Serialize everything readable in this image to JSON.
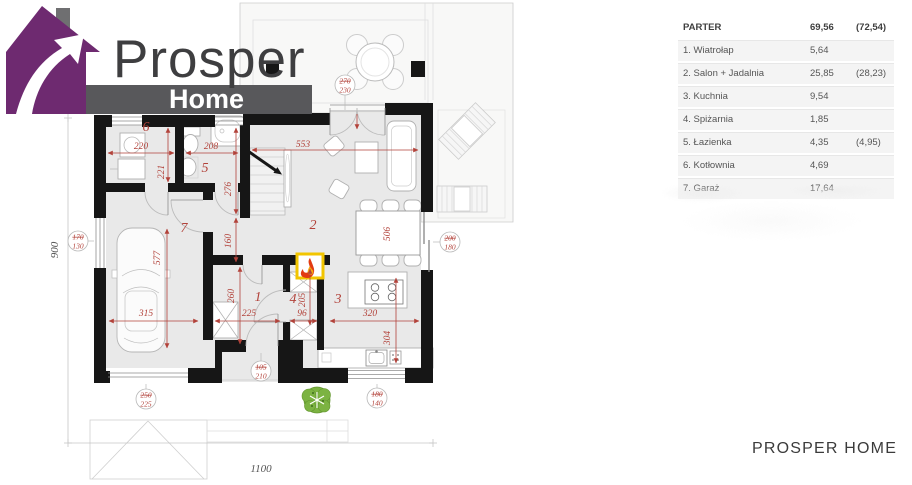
{
  "logo": {
    "title": "Prosper",
    "subtitle": "Home"
  },
  "plan": {
    "rooms": [
      "1",
      "2",
      "3",
      "4",
      "5",
      "6",
      "7"
    ],
    "dims": {
      "d220": "220",
      "d208": "208",
      "d553": "553",
      "d221": "221",
      "d276": "276",
      "d160": "160",
      "d506": "506",
      "d577": "577",
      "d315": "315",
      "d225": "225",
      "d96": "96",
      "d205": "205",
      "d260": "260",
      "d320": "320",
      "d304": "304",
      "d900": "900",
      "d1100": "1100"
    },
    "markers": [
      {
        "top": "170",
        "bottom": "130"
      },
      {
        "top": "250",
        "bottom": "225"
      },
      {
        "top": "270",
        "bottom": "230"
      },
      {
        "top": "200",
        "bottom": "180"
      },
      {
        "top": "105",
        "bottom": "210"
      },
      {
        "top": "180",
        "bottom": "140"
      }
    ],
    "icons": {
      "fireplace": "flame-icon",
      "bush": "bush-icon",
      "logo_house": "house-arrow-icon"
    }
  },
  "table": {
    "header": {
      "name": "PARTER",
      "area": "69,56",
      "area_alt": "(72,54)"
    },
    "rows": [
      {
        "name": "1. Wiatrołap",
        "area": "5,64",
        "area_alt": ""
      },
      {
        "name": "2. Salon + Jadalnia",
        "area": "25,85",
        "area_alt": "(28,23)"
      },
      {
        "name": "3. Kuchnia",
        "area": "9,54",
        "area_alt": ""
      },
      {
        "name": "4. Spiżarnia",
        "area": "1,85",
        "area_alt": ""
      },
      {
        "name": "5. Łazienka",
        "area": "4,35",
        "area_alt": "(4,95)"
      },
      {
        "name": "6. Kotłownia",
        "area": "4,69",
        "area_alt": ""
      },
      {
        "name": "7. Garaż",
        "area": "17,64",
        "area_alt": ""
      }
    ]
  },
  "footer": {
    "brand": "PROSPER HOME"
  },
  "colors": {
    "accent_purple": "#6e2a70",
    "banner_gray": "#58585b",
    "dim_red": "#b2423a",
    "wall_black": "#161616",
    "floor_gray": "#e9e9e9",
    "fireplace_yellow": "#f2c500",
    "flame_red": "#e23b12",
    "bush_green": "#7cb342"
  }
}
